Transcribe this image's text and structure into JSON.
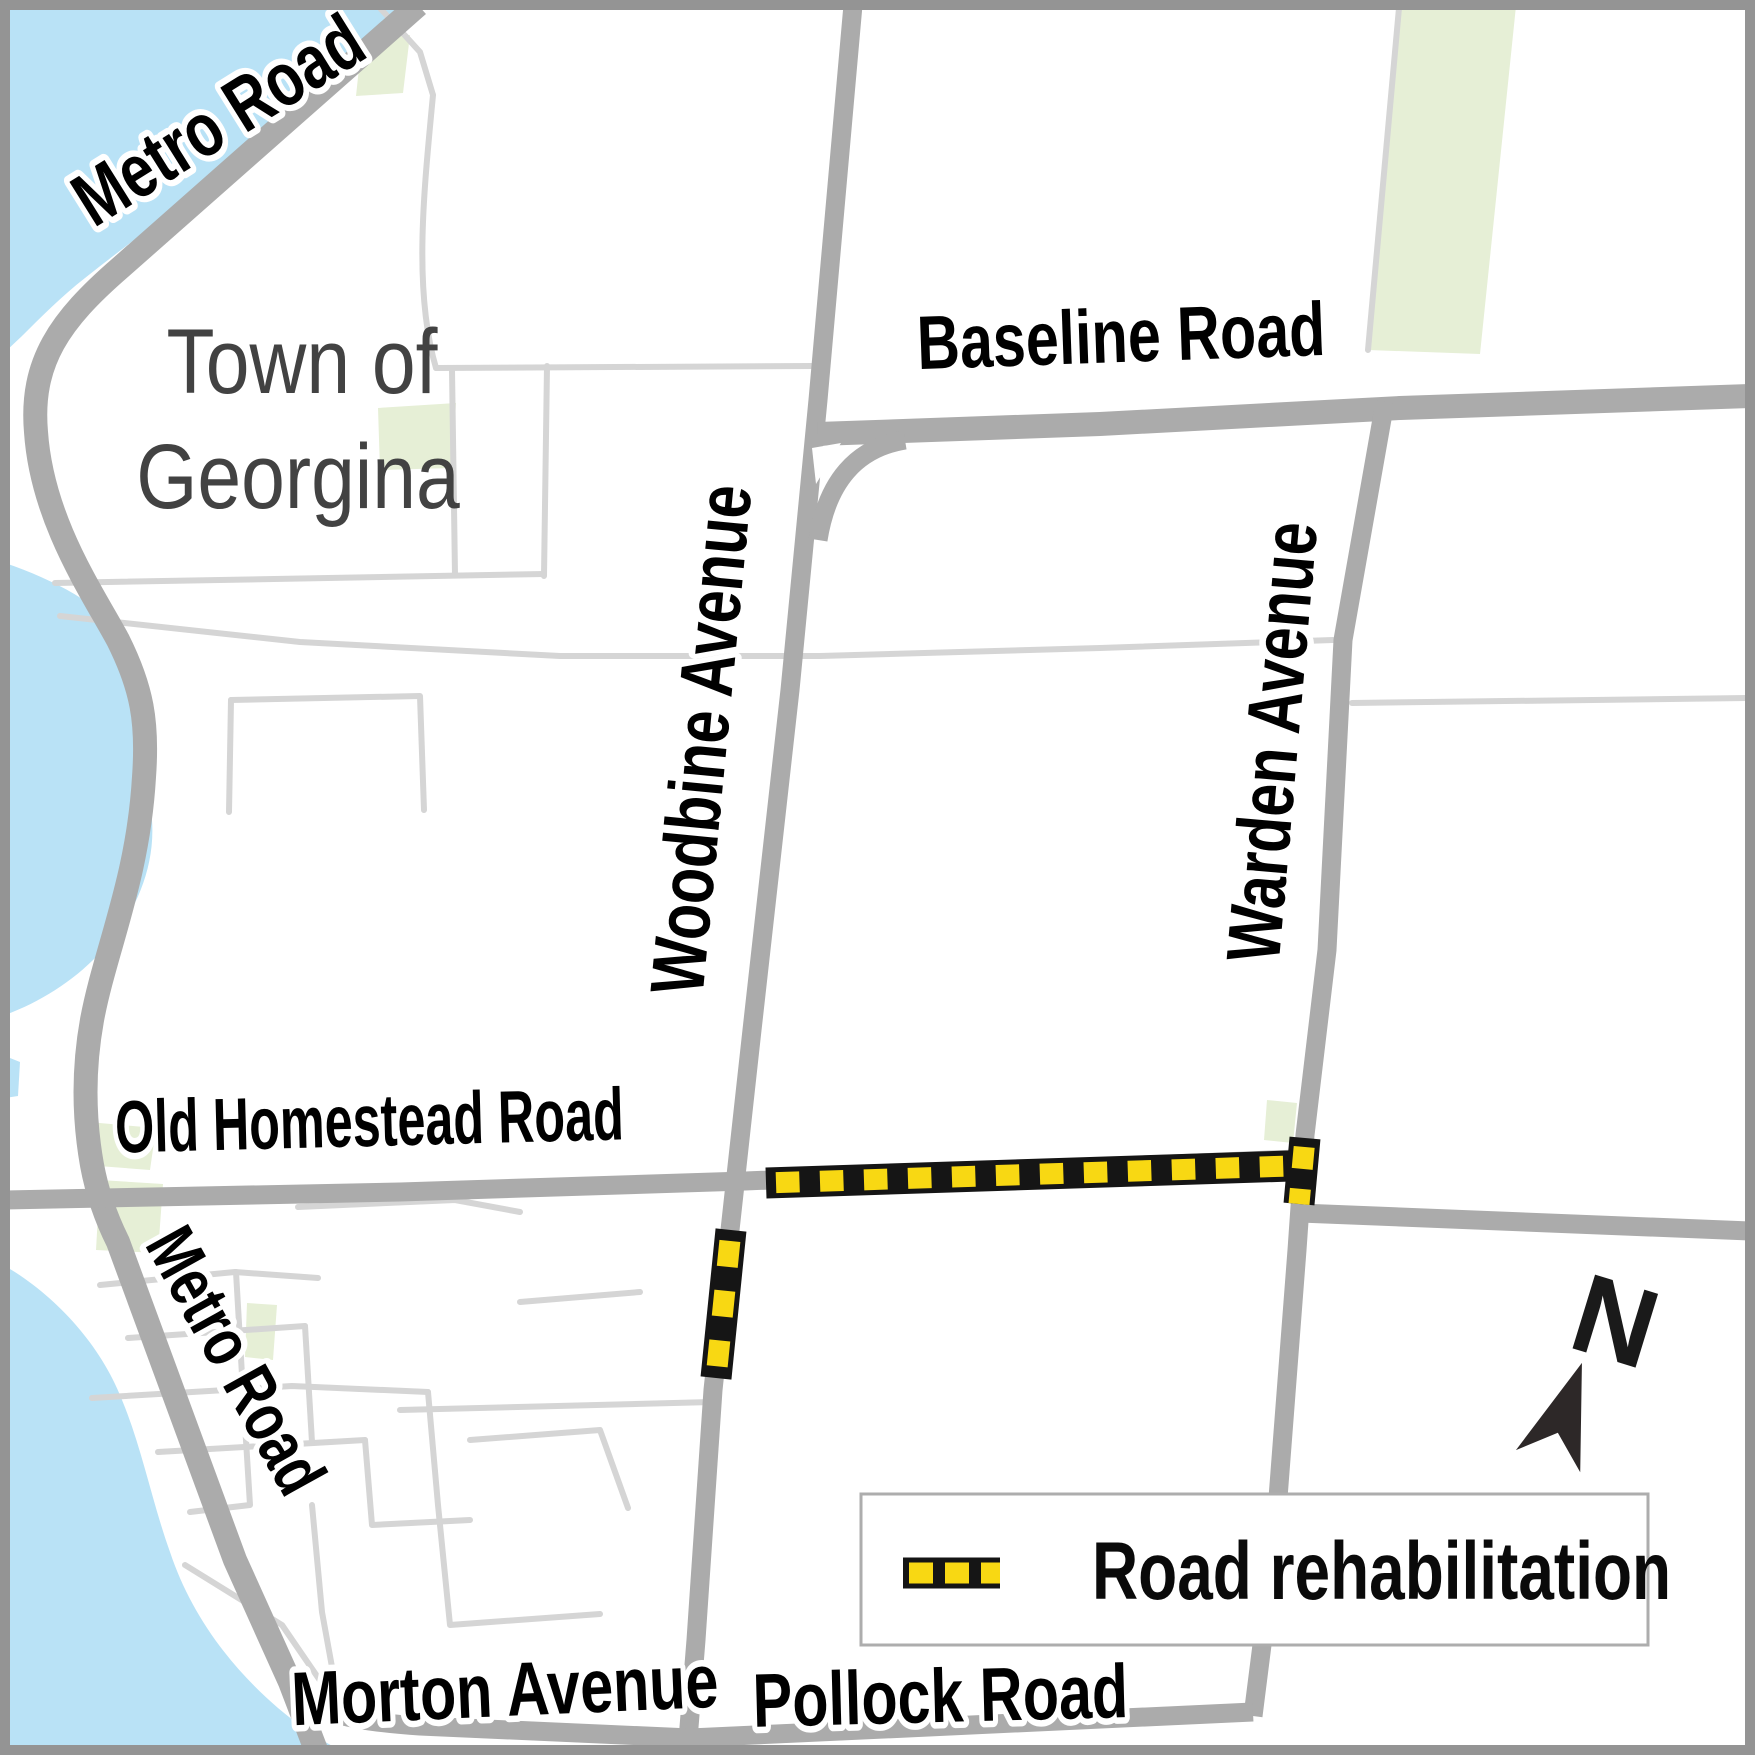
{
  "map": {
    "title": "Town of Georgina road rehabilitation map",
    "region_label": {
      "line1": "Town of",
      "line2": "Georgina"
    },
    "road_labels": {
      "metro_top": "Metro Road",
      "baseline": "Baseline Road",
      "woodbine": "Woodbine Avenue",
      "warden": "Warden Avenue",
      "old_homestead": "Old Homestead Road",
      "metro_lower": "Metro Road",
      "morton": "Morton Avenue",
      "pollock": "Pollock Road"
    },
    "legend": {
      "items": [
        {
          "label": "Road rehabilitation",
          "swatch": "black-band-with-yellow-dashes"
        }
      ]
    },
    "compass": {
      "label": "N",
      "direction": "north"
    },
    "colors": {
      "water": "#b9e2f6",
      "greenspace": "#e6efd6",
      "main_road": "#ababab",
      "thin_road": "#d5d5d5",
      "rehab_black": "#151515",
      "rehab_yellow": "#f8d813",
      "label_black": "#000000",
      "region_label_gray": "#424242",
      "border_gray": "#949494",
      "legend_border": "#adadad"
    }
  }
}
